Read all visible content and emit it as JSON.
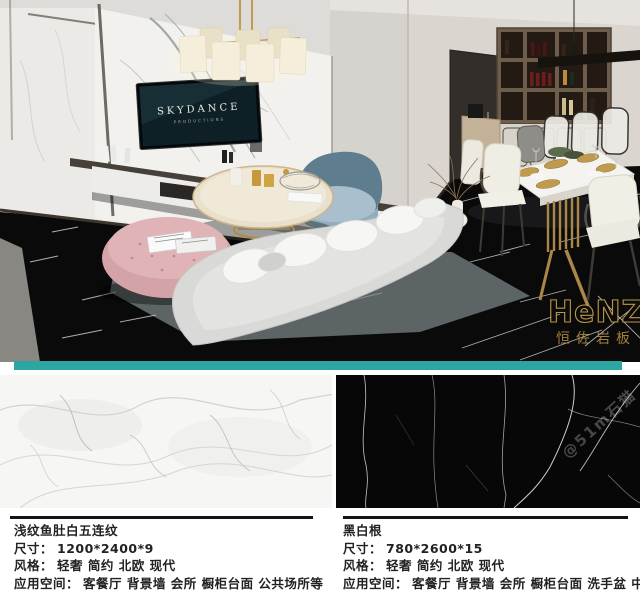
{
  "scene": {
    "tv": {
      "brand": "SKYDANCE",
      "subtitle": "PRODUCTIONS"
    },
    "brand_logo": {
      "name": "HeNZO",
      "tagline": "恒佐岩板",
      "color": "#c9a24b"
    },
    "watermark": "@51m石猫"
  },
  "divider": {
    "color": "#2ca6a0"
  },
  "products": [
    {
      "name": "浅纹鱼肚白五连纹",
      "size_label": "尺寸：",
      "size_value": "1200*2400*9",
      "style_label": "风格：",
      "style_value": "轻奢 简约 北欧 现代",
      "space_label": "应用空间：",
      "space_value": "客餐厅 背景墙 会所 橱柜台面 公共场所等"
    },
    {
      "name": "黑白根",
      "size_label": "尺寸：",
      "size_value": "780*2600*15",
      "style_label": "风格：",
      "style_value": "轻奢 简约 北欧 现代",
      "space_label": "应用空间：",
      "space_value": "客餐厅 背景墙 会所 橱柜台面 洗手盆 中岛台"
    }
  ]
}
